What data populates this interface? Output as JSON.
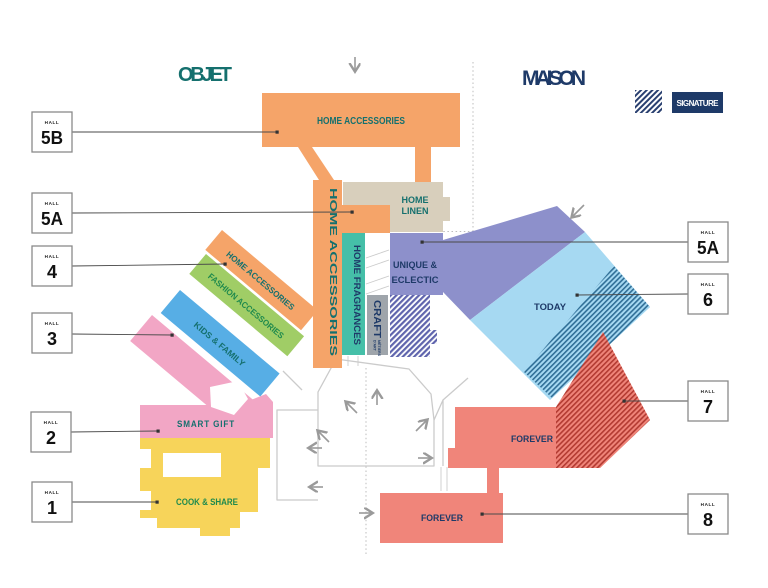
{
  "titles": {
    "left": "OBJET",
    "right": "MAISON"
  },
  "legend": {
    "label": "SIGNATURE"
  },
  "strings": {
    "hall": "HALL"
  },
  "halls": [
    {
      "number": "5B"
    },
    {
      "number": "5A"
    },
    {
      "number": "4"
    },
    {
      "number": "3"
    },
    {
      "number": "2"
    },
    {
      "number": "1"
    },
    {
      "number": "5A"
    },
    {
      "number": "6"
    },
    {
      "number": "7"
    },
    {
      "number": "8"
    }
  ],
  "zones": {
    "top_home_accessories": {
      "label": "HOME ACCESSORIES"
    },
    "vertical_home_accessories": {
      "label": "HOME ACCESSORIES"
    },
    "home_linen": {
      "line1": "HOME",
      "line2": "LINEN"
    },
    "home_fragrances": {
      "label": "HOME FRAGRANCES"
    },
    "craft": {
      "label": "CRAFT",
      "sub1": "MÉTIERS",
      "sub2": "D'ART"
    },
    "unique_eclectic": {
      "line1": "UNIQUE &",
      "line2": "ECLECTIC"
    },
    "today": {
      "label": "TODAY"
    },
    "forever_hall7": {
      "label": "FOREVER"
    },
    "forever_hall8": {
      "label": "FOREVER"
    },
    "diag_home_accessories": {
      "label": "HOME ACCESSORIES"
    },
    "fashion_accessories": {
      "label": "FASHION ACCESSORIES"
    },
    "kids_family": {
      "label": "KIDS & FAMILY"
    },
    "smart_gift": {
      "label": "SMART GIFT"
    },
    "cook_share": {
      "label": "COOK & SHARE"
    }
  },
  "colors": {
    "orange": "#F5A469",
    "beige": "#D8CFBC",
    "teal_block": "#45BFA8",
    "gray_block": "#9FA5AB",
    "purple": "#8D90CB",
    "light_blue": "#A6D9F2",
    "salmon": "#F0857A",
    "yellow": "#F7D45A",
    "pink": "#F2A6C5",
    "blue": "#57AEE5",
    "green": "#A0CD66",
    "teal_text": "#15706E",
    "navy": "#1E3A68",
    "green_text": "#1F8A4D"
  }
}
